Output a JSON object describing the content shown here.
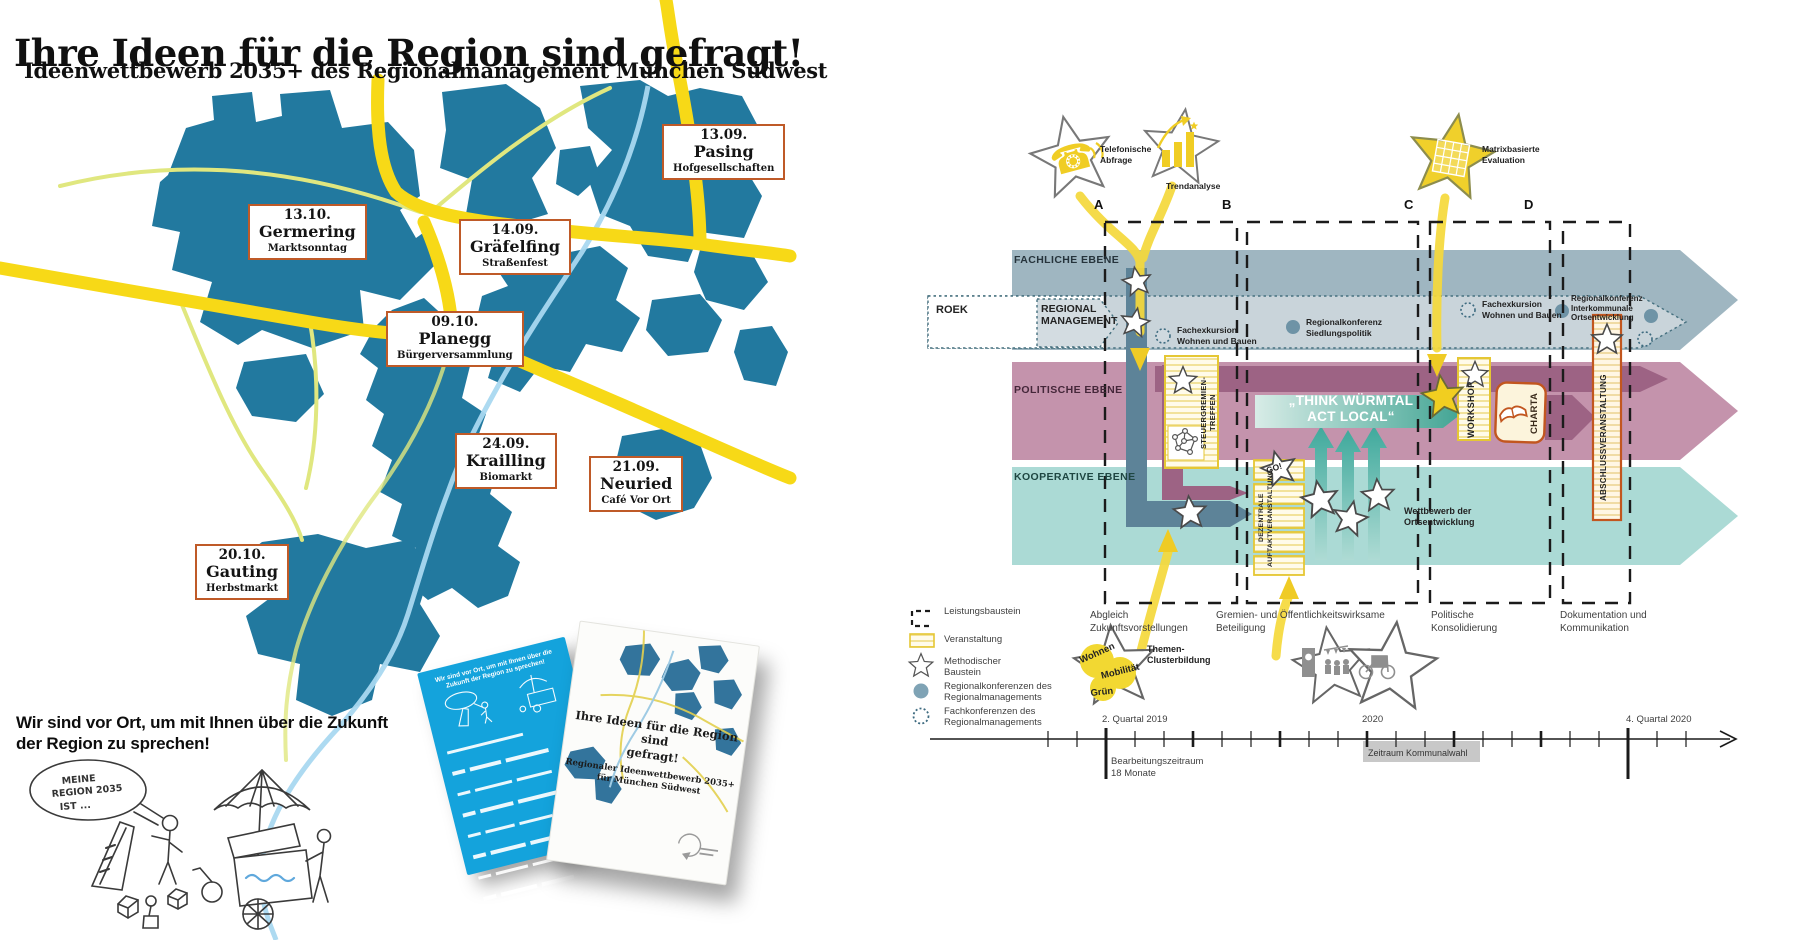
{
  "poster": {
    "title": "Ihre Ideen für die Region sind gefragt!",
    "subtitle": "Ideenwettbewerb 2035+ des Regionalmanagement München Südwest",
    "events": [
      {
        "date": "13.09.",
        "place": "Pasing",
        "info": "Hofgesellschaften"
      },
      {
        "date": "13.10.",
        "place": "Germering",
        "info": "Marktsonntag"
      },
      {
        "date": "14.09.",
        "place": "Gräfelfing",
        "info": "Straßenfest"
      },
      {
        "date": "09.10.",
        "place": "Planegg",
        "info": "Bürgerversammlung"
      },
      {
        "date": "24.09.",
        "place": "Krailling",
        "info": "Biomarkt"
      },
      {
        "date": "21.09.",
        "place": "Neuried",
        "info": "Café Vor Ort"
      },
      {
        "date": "20.10.",
        "place": "Gauting",
        "info": "Herbstmarkt"
      }
    ],
    "vor_ort": [
      "Wir sind vor Ort, um mit Ihnen über die Zukunft",
      "der Region zu sprechen!"
    ],
    "bubble": [
      "MEINE",
      "REGION 2035",
      "IST ..."
    ],
    "flyers": {
      "back_heading": [
        "Wir sind vor Ort, um mit Ihnen über die",
        "Zukunft der Region zu sprechen!"
      ],
      "front_title": [
        "Ihre Ideen für die Region sind",
        "gefragt!"
      ],
      "front_subtitle": [
        "Regionaler Ideenwettbewerb 2035+",
        "für München Südwest"
      ]
    }
  },
  "diagram": {
    "stars": {
      "phone": [
        "Telefonische",
        "Abfrage"
      ],
      "trend": [
        "Trendanalyse"
      ],
      "matrix": [
        "Matrixbasierte",
        "Evaluation"
      ]
    },
    "columns": [
      "A",
      "B",
      "C",
      "D"
    ],
    "levels": {
      "fachlich": "FACHLICHE EBENE",
      "politisch": "POLITISCHE EBENE",
      "kooperativ": "KOOPERATIVE EBENE"
    },
    "roek": "ROEK",
    "regman": [
      "REGIONAL",
      "MANAGEMENT"
    ],
    "conf": {
      "fachex1": [
        "Fachexkursion",
        "Wohnen und Bauen"
      ],
      "regkonf1": [
        "Regionalkonferenz",
        "Siedlungspolitik"
      ],
      "fachex2": [
        "Fachexkursion",
        "Wohnen und Bauen"
      ],
      "regkonf2": [
        "Regionalkonferenz",
        "Interkommunale",
        "Ortsentwicklung"
      ]
    },
    "boxes": {
      "steuer": "STEUERGREMIEN-TREFFEN",
      "dezentral": [
        "DEZENTRALE",
        "AUFTAKTVERANSTALTUNG"
      ],
      "go": "GO!",
      "workshop": "WORKSHOP",
      "charta": "CHARTA",
      "abschluss": "ABSCHLUSSVERANSTALTUNG"
    },
    "think": [
      "„THINK WÜRMTAL",
      "ACT LOCAL“"
    ],
    "wettbewerb": [
      "Wettbewerb der",
      "Ortsentwicklung"
    ],
    "phases": [
      [
        "Abgleich",
        "Zukunftsvorstellungen"
      ],
      [
        "Gremien- und Öffentlichkeitswirksame",
        "Beteiligung"
      ],
      [
        "Politische",
        "Konsolidierung"
      ],
      [
        "Dokumentation und",
        "Kommunikation"
      ]
    ],
    "legend": [
      {
        "icon": "dashed-box",
        "lines": [
          "Leistungsbaustein"
        ]
      },
      {
        "icon": "striped-box",
        "lines": [
          "Veranstaltung"
        ]
      },
      {
        "icon": "star",
        "lines": [
          "Methodischer",
          "Baustein"
        ]
      },
      {
        "icon": "filled-dot",
        "lines": [
          "Regionalkonferenzen des",
          "Regionalmanagements"
        ]
      },
      {
        "icon": "dotted-circle",
        "lines": [
          "Fachkonferenzen des",
          "Regionalmanagements"
        ]
      }
    ],
    "themes": {
      "t1": "Wohnen",
      "t2": "Mobilität",
      "t3": "Grün",
      "label": [
        "Themen-",
        "Clusterbildung"
      ]
    },
    "timeline": {
      "q_start": "2. Quartal 2019",
      "year_mid": "2020",
      "q_end": "4. Quartal 2020",
      "bearbeitung": [
        "Bearbeitungszeitraum",
        "18 Monate"
      ],
      "wahl": "Zeitraum Kommunalwahl"
    }
  },
  "colors": {
    "map_blue": "#22799F",
    "road_yellow": "#F7D917",
    "road_minor": "#E0E77F",
    "river": "#A9D8F0",
    "label_border": "#BF5A28",
    "band_grey": "#9FB6C1",
    "band_pink": "#C493AC",
    "band_teal": "#ABDAD5",
    "accent_yellow": "#F2CF1E",
    "dark_mauve": "#9D6384",
    "dark_grey_blue": "#5D8398",
    "flyer_blue": "#14A3DC"
  }
}
